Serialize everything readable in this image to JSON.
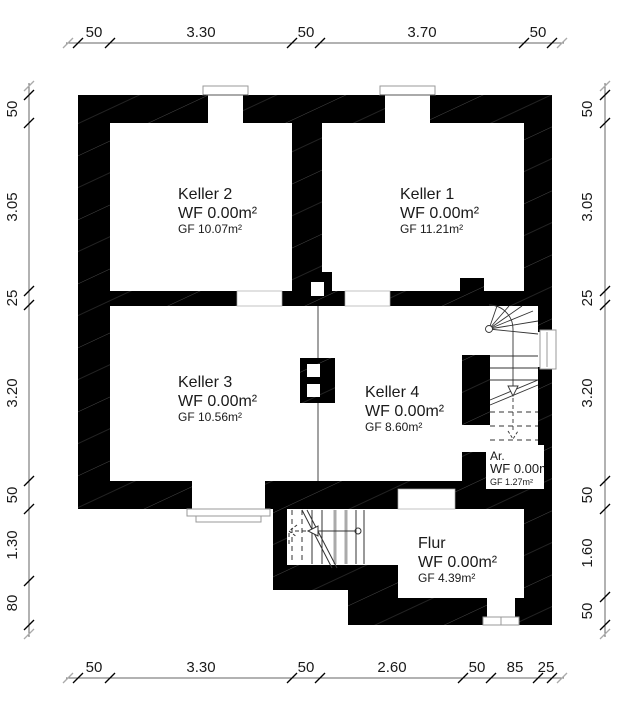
{
  "plan": {
    "title": "Kellergeschoss Grundriss",
    "colors": {
      "wall": "#000000",
      "background": "#ffffff",
      "dimension_line": "#555555",
      "text": "#1a1a1a"
    },
    "rooms": [
      {
        "name": "Keller 2",
        "wf": "WF 0.00m²",
        "gf": "GF 10.07m²"
      },
      {
        "name": "Keller 1",
        "wf": "WF 0.00m²",
        "gf": "GF 11.21m²"
      },
      {
        "name": "Keller 3",
        "wf": "WF 0.00m²",
        "gf": "GF 10.56m²"
      },
      {
        "name": "Keller 4",
        "wf": "WF 0.00m²",
        "gf": "GF 8.60m²"
      },
      {
        "name": "Ar.",
        "wf": "WF 0.00m²",
        "gf": "GF 1.27m²"
      },
      {
        "name": "Flur",
        "wf": "WF 0.00m²",
        "gf": "GF 4.39m²"
      }
    ],
    "dimensions": {
      "top": [
        "50",
        "3.30",
        "50",
        "3.70",
        "50"
      ],
      "bottom": [
        "50",
        "3.30",
        "50",
        "2.60",
        "50",
        "85",
        "25"
      ],
      "left": [
        "50",
        "3.05",
        "25",
        "3.20",
        "50",
        "1.30",
        "80"
      ],
      "right": [
        "50",
        "3.05",
        "25",
        "3.20",
        "50",
        "1.60",
        "50"
      ]
    }
  }
}
